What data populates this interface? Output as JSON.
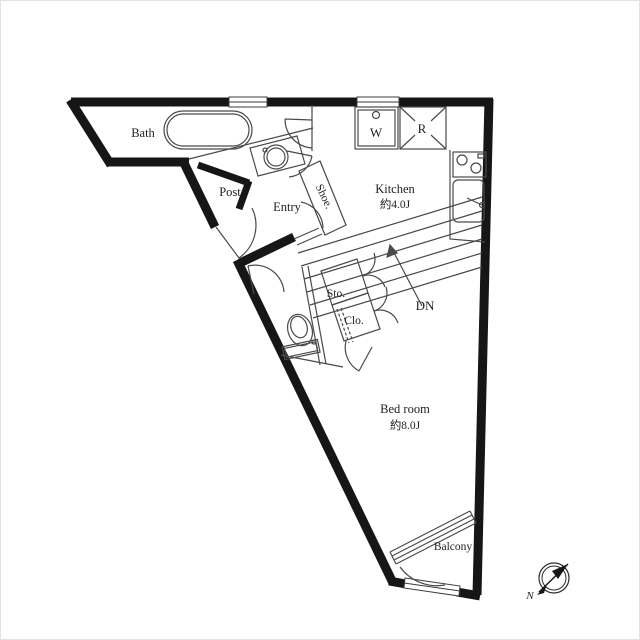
{
  "floorplan": {
    "rooms": {
      "bath": "Bath",
      "post": "Post",
      "entry": "Entry",
      "shoe": "Shoe.",
      "kitchen": "Kitchen",
      "kitchen_size": "約4.0J",
      "washer": "W",
      "refrigerator": "R",
      "storage": "Sto.",
      "closet": "Clo.",
      "stairs_dn": "DN",
      "bedroom": "Bed room",
      "bedroom_size": "約8.0J",
      "balcony": "Balcony"
    },
    "compass": {
      "label": "N"
    },
    "colors": {
      "wall": "#161616",
      "line": "#4a4a4a",
      "background": "#ffffff"
    }
  }
}
